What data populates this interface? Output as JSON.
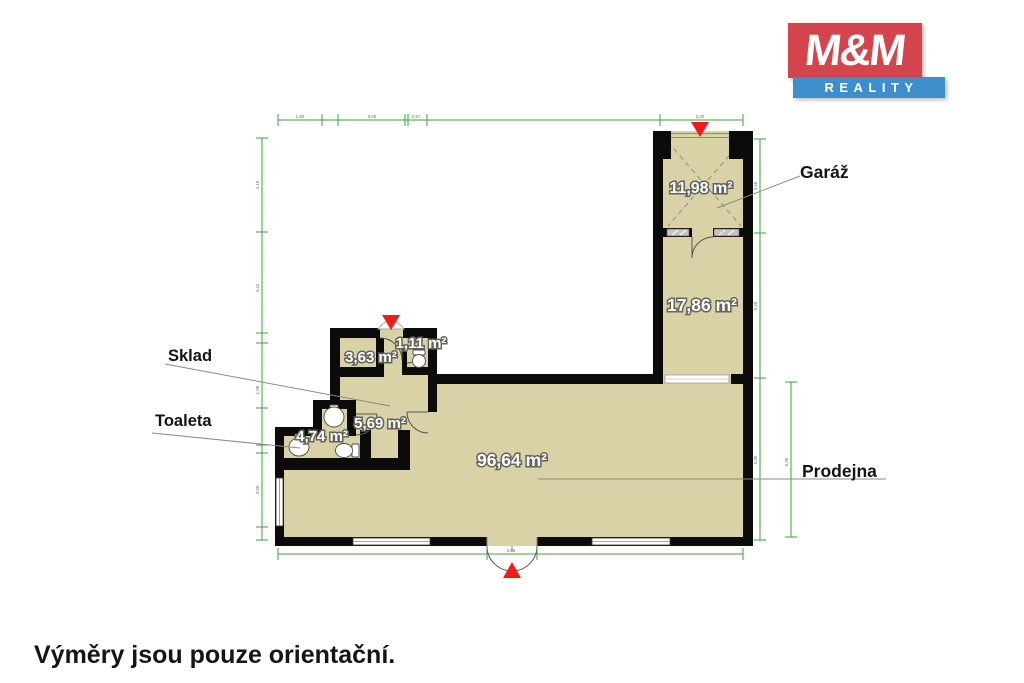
{
  "logo": {
    "top": "M&M",
    "bottom": "REALITY"
  },
  "disclaimer": "Výměry jsou pouze orientační.",
  "callouts": {
    "garage": "Garáž",
    "storage": "Sklad",
    "toilet": "Toaleta",
    "shop": "Prodejna"
  },
  "areas": {
    "garage": "11,98 m²",
    "room": "17,86 m²",
    "storage": "3,63 m²",
    "wc": "1,11 m²",
    "hall": "5,69 m²",
    "toilet": "4,74 m²",
    "shop": "96,64 m²"
  },
  "dim_labels": {
    "top": [
      "1,90",
      "3,05",
      "0,97",
      "3,20"
    ],
    "left": [
      "4,10",
      "4,42",
      "1,98",
      "3,65"
    ],
    "right": [
      "3,56",
      "5,59",
      "6,80"
    ],
    "right_inner": [
      "6,95"
    ],
    "bottom": [
      "2,05"
    ]
  },
  "colors": {
    "floor_fill": "#d9d2a6",
    "wall": "#0b0b0b",
    "dimension_line": "#3aa339",
    "entrance_marker": "#ee1c1c",
    "logo_red": "#d4444c",
    "logo_blue": "#3d8fcc"
  }
}
